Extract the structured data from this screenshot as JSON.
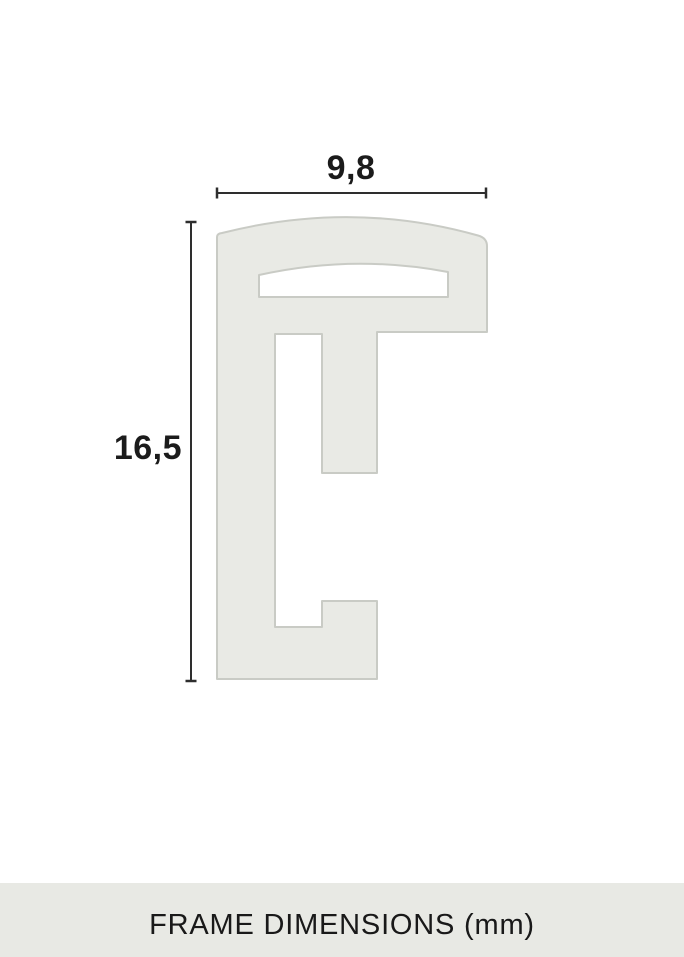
{
  "diagram": {
    "kind": "frame-profile-cross-section",
    "width_label": "9,8",
    "height_label": "16,5",
    "caption": "FRAME DIMENSIONS (mm)",
    "unit": "mm",
    "colors": {
      "background": "#ffffff",
      "profile_fill": "#e9eae5",
      "profile_stroke": "#c9cbc5",
      "dimension_line": "#2e2e2e",
      "label_text": "#1b1b1b",
      "caption_bar_bg": "#e8e9e4",
      "caption_text": "#191919"
    }
  }
}
